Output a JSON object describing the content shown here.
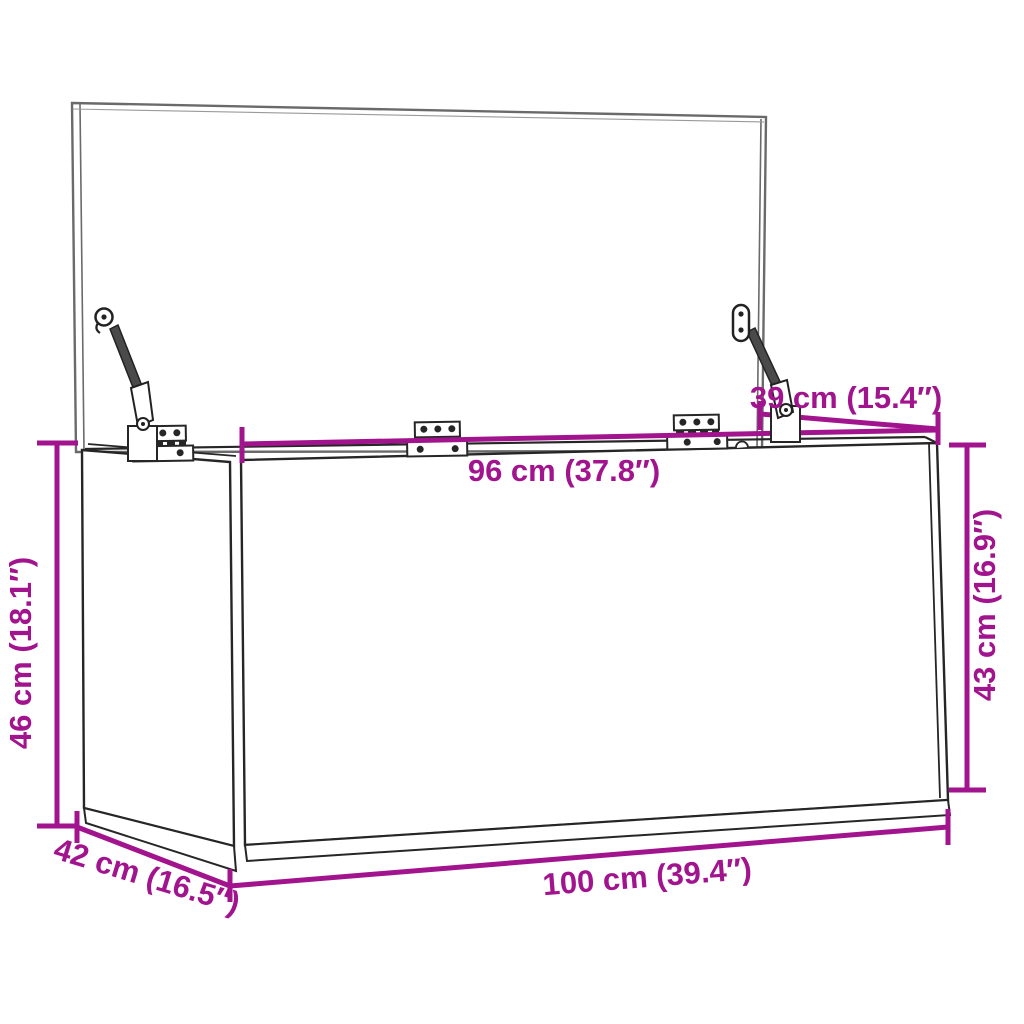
{
  "diagram": {
    "type": "product-dimension-diagram",
    "subject": "storage chest with open lid, lid stays and hinges",
    "accent_color": "#A2138E",
    "line_color": "#262626",
    "dimensions": {
      "overall_width": {
        "value_cm": 100,
        "value_in": 39.4,
        "label": "100 cm (39.4″)"
      },
      "overall_depth": {
        "value_cm": 42,
        "value_in": 16.5,
        "label": "42 cm (16.5″)"
      },
      "overall_height": {
        "value_cm": 46,
        "value_in": 18.1,
        "label": "46 cm (18.1″)"
      },
      "inner_width": {
        "value_cm": 96,
        "value_in": 37.8,
        "label": "96 cm (37.8″)"
      },
      "front_height": {
        "value_cm": 43,
        "value_in": 16.9,
        "label": "43 cm (16.9″)"
      },
      "lid_depth": {
        "value_cm": 39,
        "value_in": 15.4,
        "label": "39 cm (15.4″)"
      }
    }
  }
}
